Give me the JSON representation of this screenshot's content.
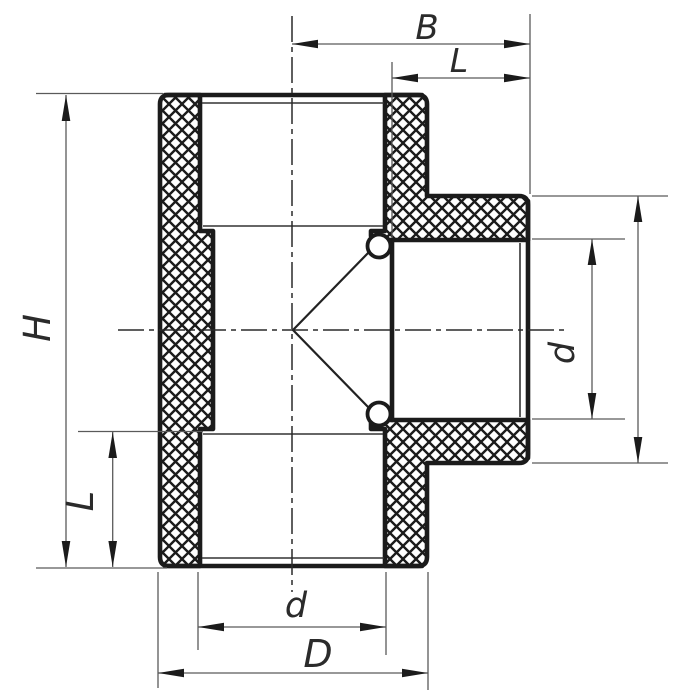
{
  "drawing": {
    "title": "pipe-tee-fitting-section",
    "view": "cross-section with crosshatched walls",
    "dimensions": {
      "top_width": "B",
      "top_socket_depth": "L",
      "height": "H",
      "left_socket_depth": "L",
      "branch_inner_diameter": "d",
      "bottom_inner_diameter": "d",
      "bottom_outer_diameter": "D"
    },
    "colors": {
      "background": "#ffffff",
      "outline": "#1b1b1b",
      "thin_line": "#5a5a5a",
      "centerline": "#2a2a2a",
      "label": "#2b2b2b"
    }
  }
}
